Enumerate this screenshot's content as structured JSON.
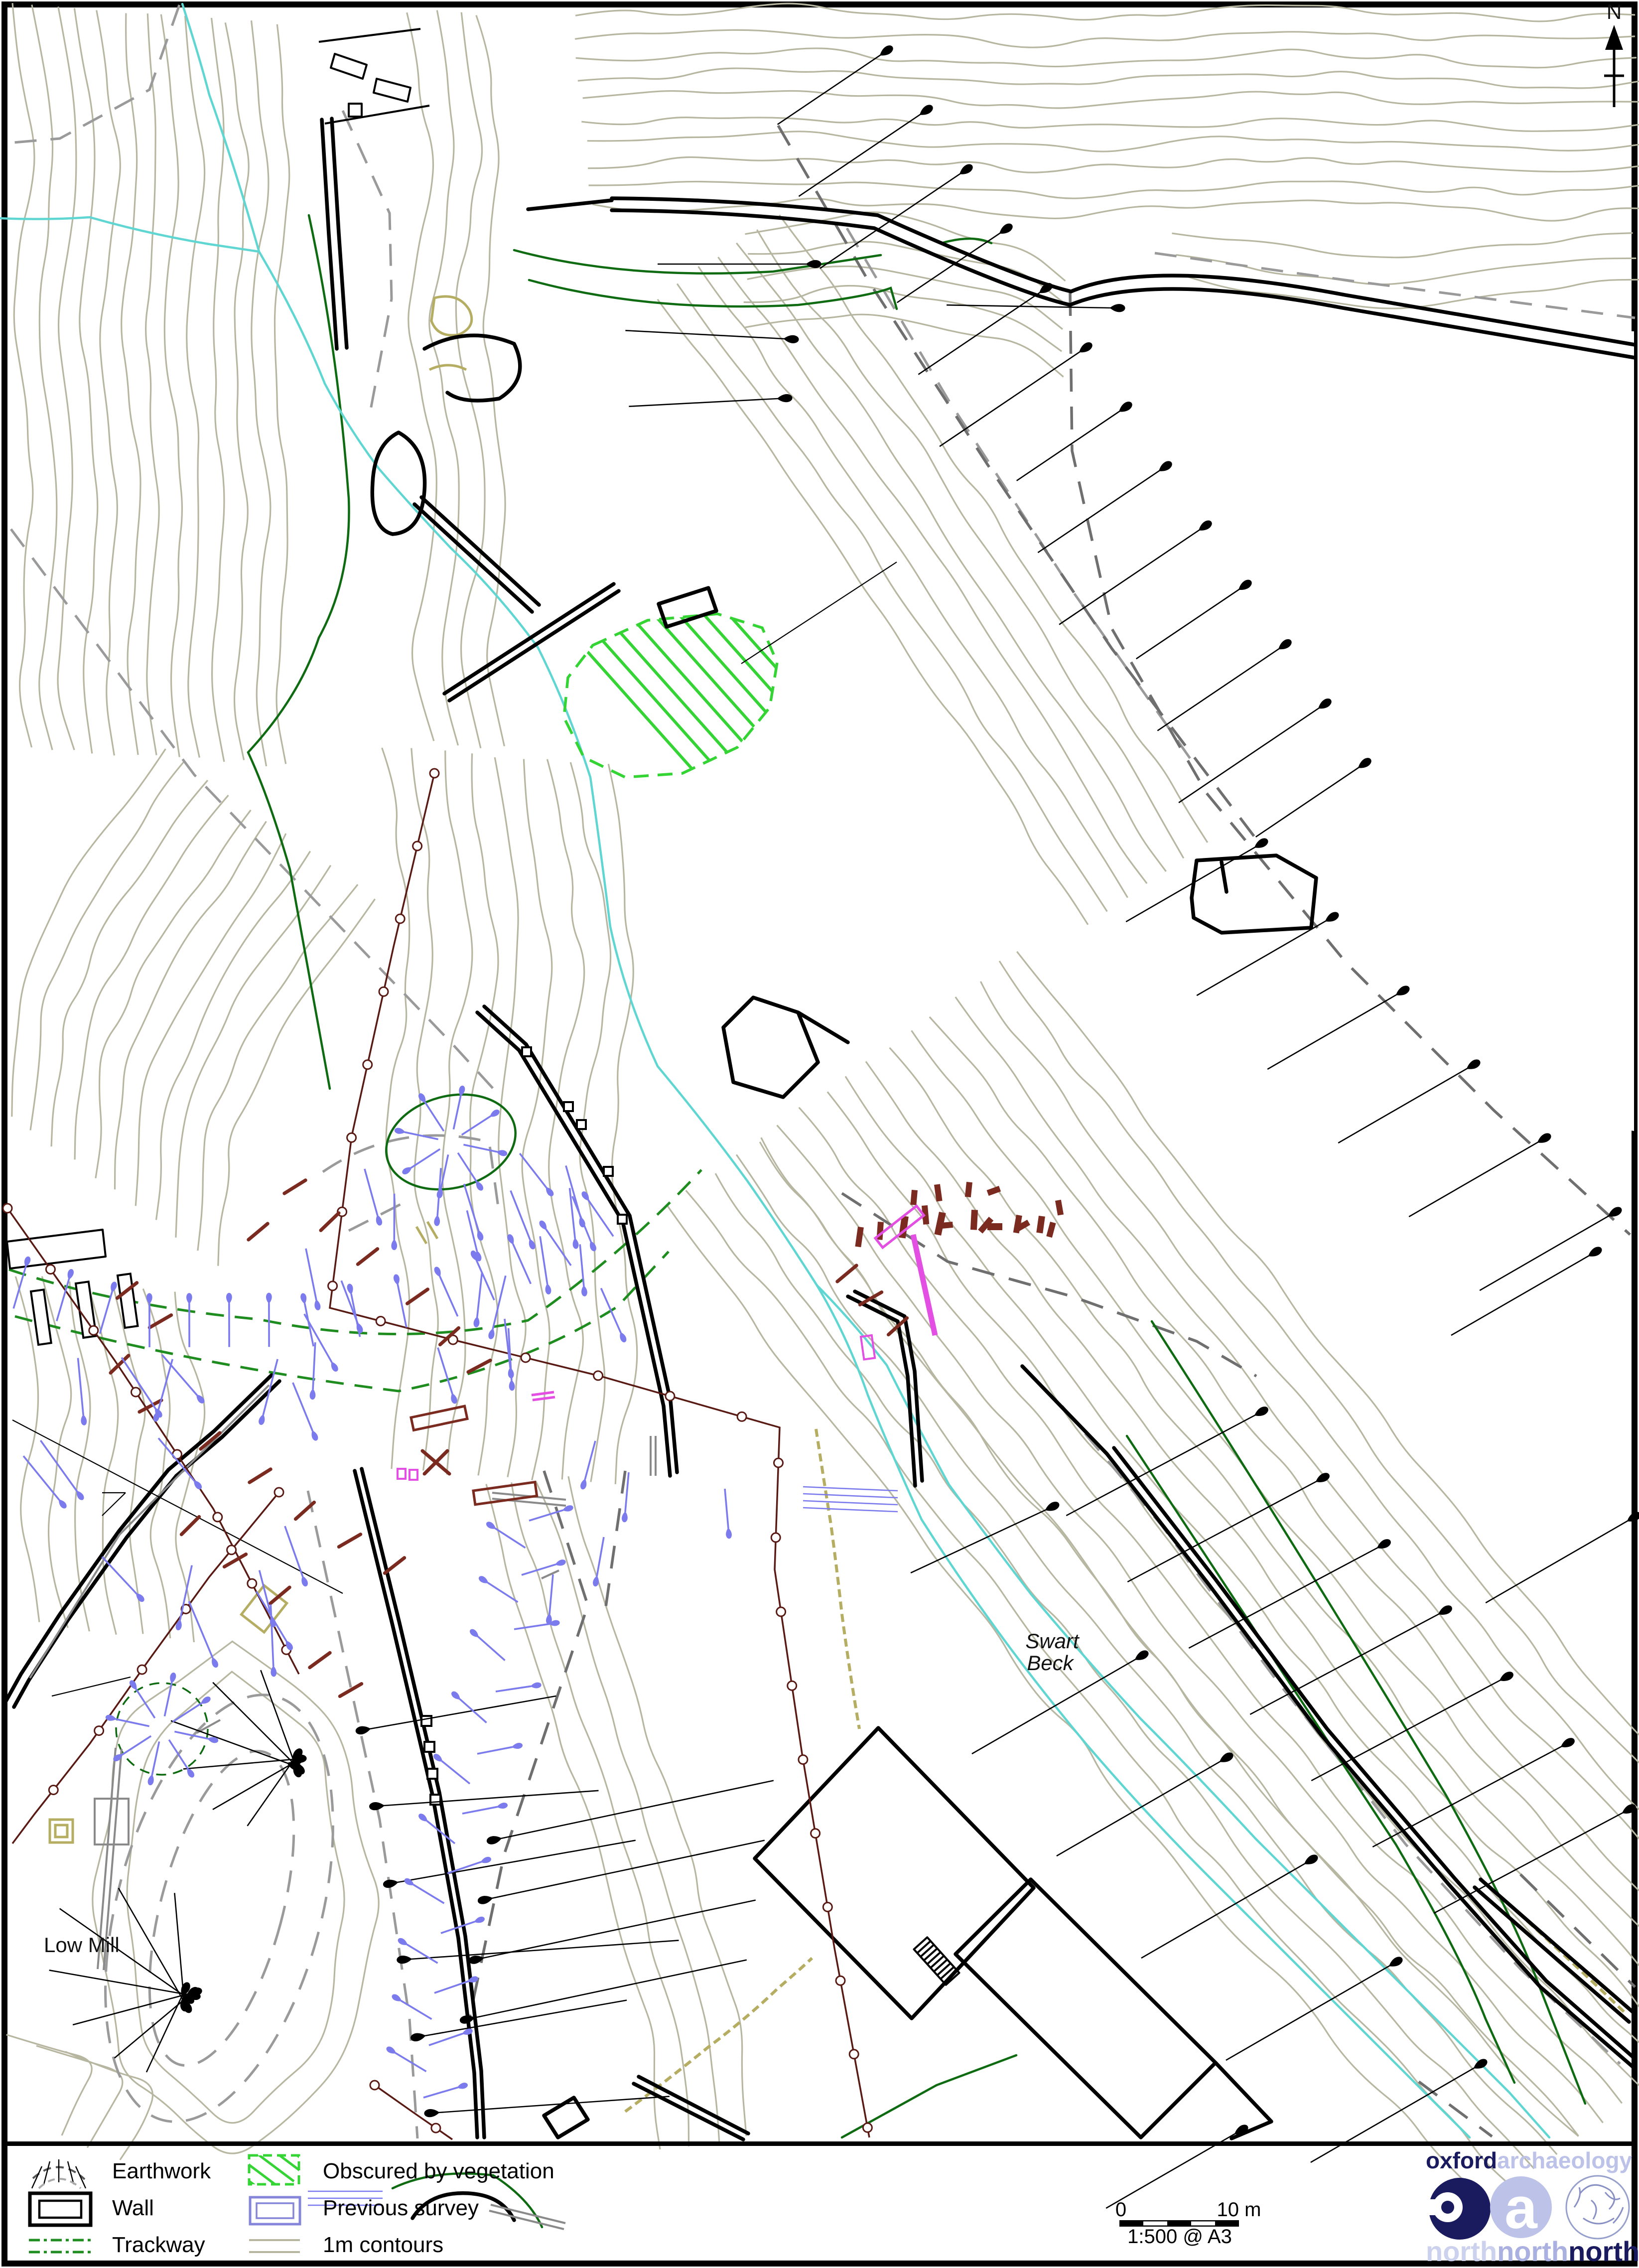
{
  "map": {
    "north_label": "N",
    "labels": {
      "swart_line1": "Swart",
      "swart_line2": "Beck",
      "low_mill": "Low Mill"
    }
  },
  "legend": {
    "items": [
      {
        "label": "Earthwork"
      },
      {
        "label": "Wall"
      },
      {
        "label": "Trackway"
      },
      {
        "label": "Obscured by vegetation"
      },
      {
        "label": "Previous survey"
      },
      {
        "label": "1m contours"
      }
    ]
  },
  "scalebar": {
    "zero": "0",
    "ten": "10 m",
    "ratio": "1:500 @ A3"
  },
  "logo": {
    "oxford": "oxford",
    "archaeology": "archaeology",
    "a": "a",
    "north1": "north",
    "north2": "north",
    "north3": "north"
  },
  "colors": {
    "contour": "#b7b7a1",
    "stream": "#5fd6d2",
    "veg": "#35d435",
    "green_dark": "#0f6b12",
    "trackway": "#1f8c1f",
    "gray_dash": "#9a9a9a",
    "gray_dash_dark": "#6f6f6f",
    "blue": "#7b7bed",
    "blue_legend": "#8585d9",
    "maroon": "#7a2a1e",
    "fence": "#5a1a14",
    "magenta": "#e24fe2",
    "khaki": "#b5ad62",
    "navy": "#1a1a5e",
    "lavender": "#bcc2e8"
  }
}
